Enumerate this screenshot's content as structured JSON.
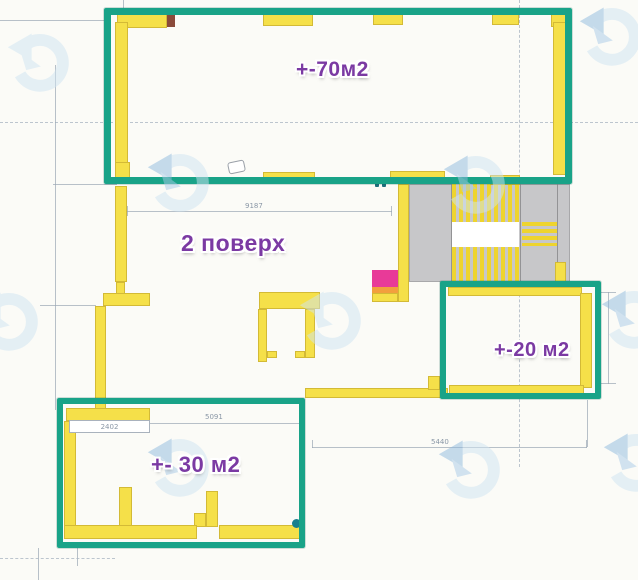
{
  "document": {
    "type": "apartment-floor-plan"
  },
  "labels": {
    "area_top": "+-70м2",
    "floor": "2 поверх",
    "area_right": "+-20 м2",
    "area_bottom": "+- 30 м2"
  },
  "dimensions": {
    "mid_width": "9187",
    "box30_left_width": "2402",
    "box30_top_width": "5091",
    "bottom_width": "5440"
  },
  "colors": {
    "highlight_green": "#19a388",
    "wall_yellow": "#f5e049",
    "stair_gray": "#c7c7c9",
    "accent_pink": "#e83a98",
    "accent_orange": "#f2a03d",
    "label_purple": "#7b3aa3",
    "watermark_light": "#cfe4f3",
    "watermark_dark": "#8fbadf",
    "line_gray": "#9aa6b4",
    "dim_text": "#8a97a6",
    "marker_teal": "#17808e"
  },
  "icons": {
    "watermark": "circular-arrow-watermark"
  }
}
